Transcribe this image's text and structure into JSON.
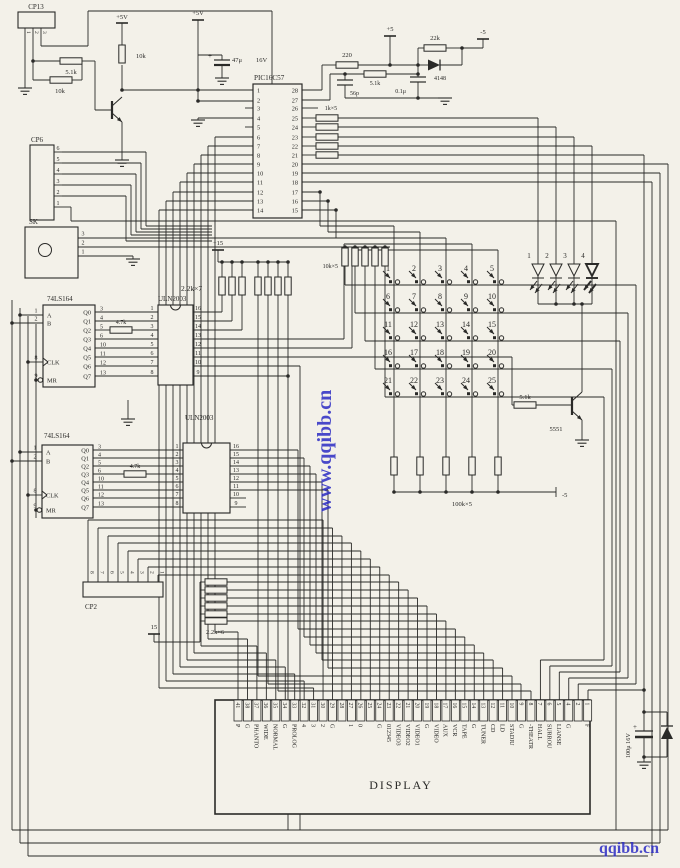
{
  "supplies": {
    "p5v_a": "+5V",
    "p5v_b": "+5V",
    "p5": "+5",
    "m5": "-5",
    "p15": "+15",
    "p15b": "15",
    "m5b": "-5"
  },
  "connectors": {
    "cp13": {
      "name": "CP13",
      "pins": [
        "1",
        "2",
        "3"
      ]
    },
    "cp6": {
      "name": "CP6",
      "pins": [
        "6",
        "5",
        "4",
        "3",
        "2",
        "1"
      ]
    },
    "sk": {
      "name": "SK",
      "pins": [
        "3",
        "2",
        "1"
      ]
    },
    "cp2": {
      "name": "CP2",
      "pins": [
        "8",
        "7",
        "6",
        "5",
        "4",
        "3",
        "2",
        "1"
      ]
    }
  },
  "ics": {
    "pic": {
      "name": "PIC16C57",
      "left_pins": [
        "1",
        "2",
        "3",
        "4",
        "5",
        "6",
        "7",
        "8",
        "9",
        "10",
        "11",
        "12",
        "13",
        "14"
      ],
      "right_pins": [
        "28",
        "27",
        "26",
        "25",
        "24",
        "23",
        "22",
        "21",
        "20",
        "19",
        "18",
        "17",
        "16",
        "15"
      ]
    },
    "shift1": {
      "name": "74LS164",
      "input_pins": [
        "1",
        "2",
        "8",
        "9"
      ],
      "input_labels": [
        "A",
        "B",
        "CLK",
        "MR"
      ],
      "output_pins": [
        "3",
        "4",
        "5",
        "6",
        "10",
        "11",
        "12",
        "13"
      ],
      "output_labels": [
        "Q0",
        "Q1",
        "Q2",
        "Q3",
        "Q4",
        "Q5",
        "Q6",
        "Q7"
      ]
    },
    "shift2": {
      "name": "74LS164",
      "input_pins": [
        "1",
        "2",
        "8",
        "9"
      ],
      "input_labels": [
        "A",
        "B",
        "CLK",
        "MR"
      ],
      "output_pins": [
        "3",
        "4",
        "5",
        "6",
        "10",
        "11",
        "12",
        "13"
      ],
      "output_labels": [
        "Q0",
        "Q1",
        "Q2",
        "Q3",
        "Q4",
        "Q5",
        "Q6",
        "Q7"
      ]
    },
    "driver1": {
      "name": "ULN2003",
      "left_pins": [
        "1",
        "2",
        "3",
        "4",
        "5",
        "6",
        "7",
        "8"
      ],
      "right_pins": [
        "16",
        "15",
        "14",
        "13",
        "12",
        "11",
        "10",
        "9"
      ]
    },
    "driver2": {
      "name": "ULN2003",
      "left_pins": [
        "1",
        "2",
        "3",
        "4",
        "5",
        "6",
        "7",
        "8"
      ],
      "right_pins": [
        "16",
        "15",
        "14",
        "13",
        "12",
        "11",
        "10",
        "9"
      ]
    }
  },
  "resistors": {
    "r5k1_a": "5.1k",
    "r10k_a": "10k",
    "r10k_b": "10k",
    "r220": "220",
    "r5k1_b": "5.1k",
    "r22k": "22k",
    "r1k5": "1k×5",
    "r10k5": "10k×5",
    "r2k2_7": "2.2k×7",
    "r4k7_a": "4.7k",
    "r4k7_b": "4.7k",
    "r100k5": "100k×5",
    "r5k1_c": "5.1k",
    "r2k2_6": "2.2k×6"
  },
  "capacitors": {
    "c47": "47μ",
    "c47_v": "16V",
    "c56": "56p",
    "c01": "0.1μ",
    "c100": "100μ  16V",
    "plus": "+"
  },
  "semiconductors": {
    "d4148": "4148",
    "q5551": "5551"
  },
  "keypad": {
    "keys": [
      "1",
      "2",
      "3",
      "4",
      "5",
      "6",
      "7",
      "8",
      "9",
      "10",
      "11",
      "12",
      "13",
      "14",
      "15",
      "16",
      "17",
      "18",
      "19",
      "20",
      "21",
      "22",
      "23",
      "24",
      "25"
    ]
  },
  "leds": {
    "numbers": [
      "1",
      "2",
      "3",
      "4"
    ]
  },
  "display": {
    "name": "DISPLAY",
    "pins": [
      {
        "n": "41",
        "label": "P"
      },
      {
        "n": "38",
        "label": "G"
      },
      {
        "n": "37",
        "label": "PHANTO"
      },
      {
        "n": "36",
        "label": "WIDE"
      },
      {
        "n": "35",
        "label": "NORMAL"
      },
      {
        "n": "34",
        "label": "G"
      },
      {
        "n": "33",
        "label": "PROLOG"
      },
      {
        "n": "32",
        "label": "4"
      },
      {
        "n": "31",
        "label": "3"
      },
      {
        "n": "30",
        "label": "2"
      },
      {
        "n": "29",
        "label": "G"
      },
      {
        "n": "28",
        "label": ""
      },
      {
        "n": "27",
        "label": "1"
      },
      {
        "n": "26",
        "label": "0"
      },
      {
        "n": "25",
        "label": ""
      },
      {
        "n": "24",
        "label": "G"
      },
      {
        "n": "23",
        "label": "012345"
      },
      {
        "n": "22",
        "label": "VIDEO3"
      },
      {
        "n": "21",
        "label": "VIDEO2"
      },
      {
        "n": "20",
        "label": "VIDEO1"
      },
      {
        "n": "19",
        "label": "G"
      },
      {
        "n": "18",
        "label": "VIDEO"
      },
      {
        "n": "17",
        "label": "AUX"
      },
      {
        "n": "16",
        "label": "VCR"
      },
      {
        "n": "15",
        "label": "TAPE"
      },
      {
        "n": "14",
        "label": "G"
      },
      {
        "n": "13",
        "label": "TUNER"
      },
      {
        "n": "12",
        "label": "CD"
      },
      {
        "n": "11",
        "label": "LD"
      },
      {
        "n": "10",
        "label": "STADIU"
      },
      {
        "n": "9",
        "label": "G"
      },
      {
        "n": "8",
        "label": "-THEATR"
      },
      {
        "n": "7",
        "label": "HALL"
      },
      {
        "n": "6",
        "label": "SURROU"
      },
      {
        "n": "5",
        "label": "LIANSE"
      },
      {
        "n": "4",
        "label": "G"
      },
      {
        "n": "2",
        "label": ""
      },
      {
        "n": "1",
        "label": "F"
      }
    ]
  },
  "watermarks": {
    "vertical": "www.qqibb.cn",
    "corner": "qqibb.cn"
  },
  "colors": {
    "ink": "#2a2a28",
    "paper": "#f3f1e9",
    "watermark": "#2b2bc4"
  }
}
